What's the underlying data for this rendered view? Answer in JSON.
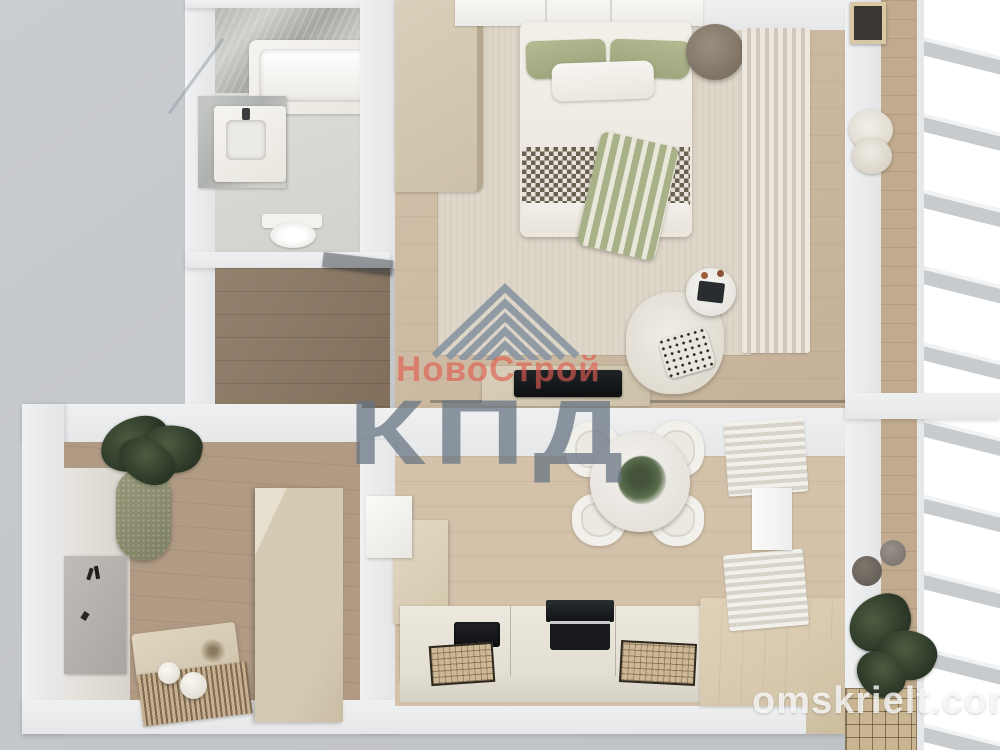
{
  "watermark": {
    "logo_icon": "roof-chevron-icon",
    "brand_name": "НовоСтрой",
    "brand_letters": "КПД",
    "brand_color": "#df5548",
    "letters_color": "#677483"
  },
  "site_credit": {
    "text": "omskrielt.com",
    "color": "#ffffff"
  },
  "palette": {
    "background_gray": "#c4c7cb",
    "wall_white": "#eceff1",
    "rug_beige": "#ded6c9",
    "wood_light": "#cdbaa1",
    "wood_dark": "#8d7a66",
    "accent_green": "#adb388",
    "counter_cream": "#e9e5da"
  }
}
